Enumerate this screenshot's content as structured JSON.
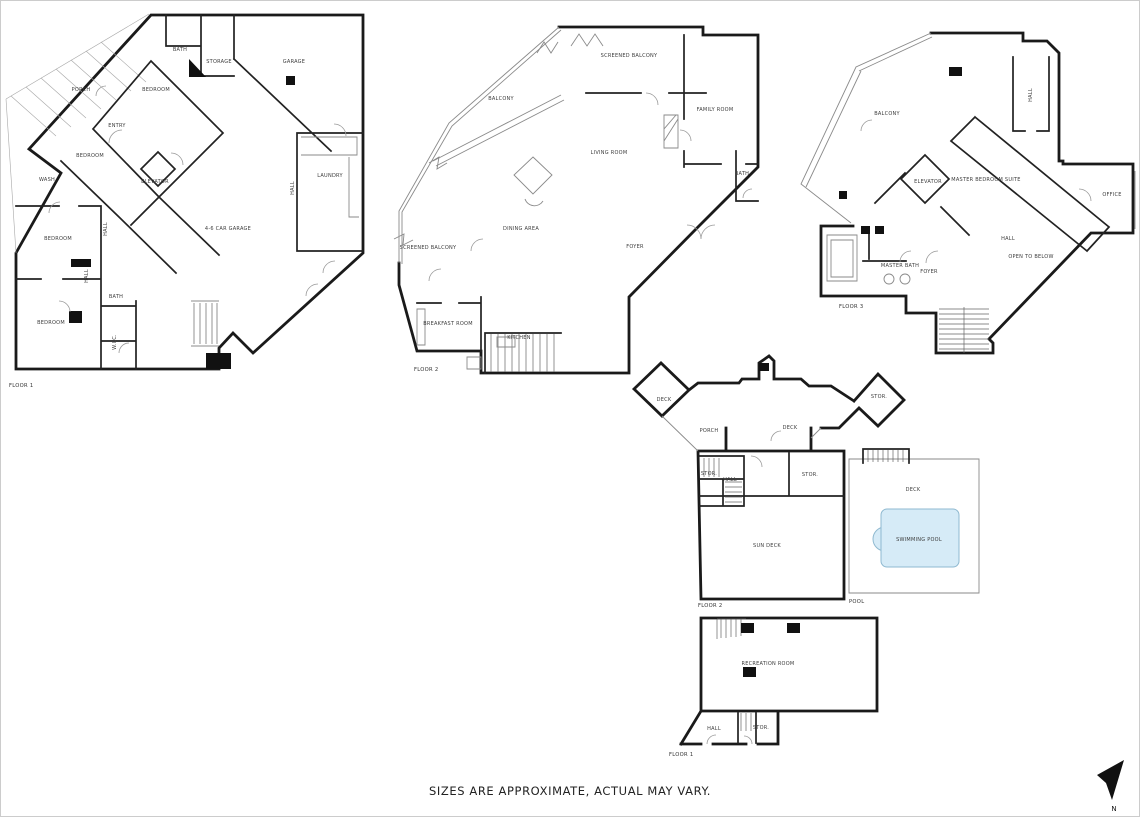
{
  "sheet": {
    "footer_disclaimer": "SIZES ARE APPROXIMATE, ACTUAL MAY VARY.",
    "compass_label": "N"
  },
  "colors": {
    "wall": "#1a1a1a",
    "thin_line": "#8a8a8a",
    "label_text": "#3c3c3c",
    "pool_fill": "#d6ebf7",
    "pool_stroke": "#8fb9d0"
  },
  "floor1": {
    "label": "FLOOR 1",
    "rooms": {
      "porch": "PORCH",
      "bath1": "BATH",
      "storage": "STORAGE",
      "garage": "GARAGE",
      "bedroom1": "BEDROOM",
      "entry": "ENTRY",
      "bedroom2": "BEDROOM",
      "wash": "WASH",
      "elevator": "ELEVATOR",
      "laundry": "LAUNDRY",
      "hall1": "HALL",
      "bedroom3": "BEDROOM",
      "hall2": "HALL",
      "main_garage": "4-6 CAR GARAGE",
      "bedroom4": "BEDROOM",
      "bath2": "BATH",
      "wic": "W.I.C.",
      "hall3": "HALL"
    }
  },
  "floor2": {
    "label": "FLOOR 2",
    "rooms": {
      "screened_balcony_top": "SCREENED BALCONY",
      "balcony": "BALCONY",
      "family_room": "FAMILY ROOM",
      "living_room": "LIVING ROOM",
      "bath": "BATH",
      "dining_area": "DINING AREA",
      "screened_balcony_left": "SCREENED BALCONY",
      "foyer": "FOYER",
      "breakfast_room": "BREAKFAST ROOM",
      "kitchen": "KITCHEN"
    }
  },
  "floor3": {
    "label": "FLOOR 3",
    "rooms": {
      "balcony": "BALCONY",
      "hall1": "HALL",
      "elevator": "ELEVATOR",
      "master_suite": "MASTER BEDROOM SUITE",
      "office": "OFFICE",
      "master_bath": "MASTER BATH",
      "foyer": "FOYER",
      "hall2": "HALL",
      "open_to_below": "OPEN TO BELOW"
    }
  },
  "deck_level": {
    "label": "FLOOR 2",
    "rooms": {
      "deck_left": "DECK",
      "porch": "PORCH",
      "deck_center": "DECK",
      "stor_right": "STOR.",
      "stor_a": "STOR.",
      "hall": "HALL",
      "stor_b": "STOR.",
      "sun_deck": "SUN DECK"
    }
  },
  "pool_area": {
    "label": "POOL",
    "rooms": {
      "deck": "DECK",
      "pool": "SWIMMING POOL"
    }
  },
  "lower_level": {
    "label": "FLOOR 1",
    "rooms": {
      "recreation": "RECREATION ROOM",
      "hall": "HALL",
      "stor": "STOR."
    }
  }
}
